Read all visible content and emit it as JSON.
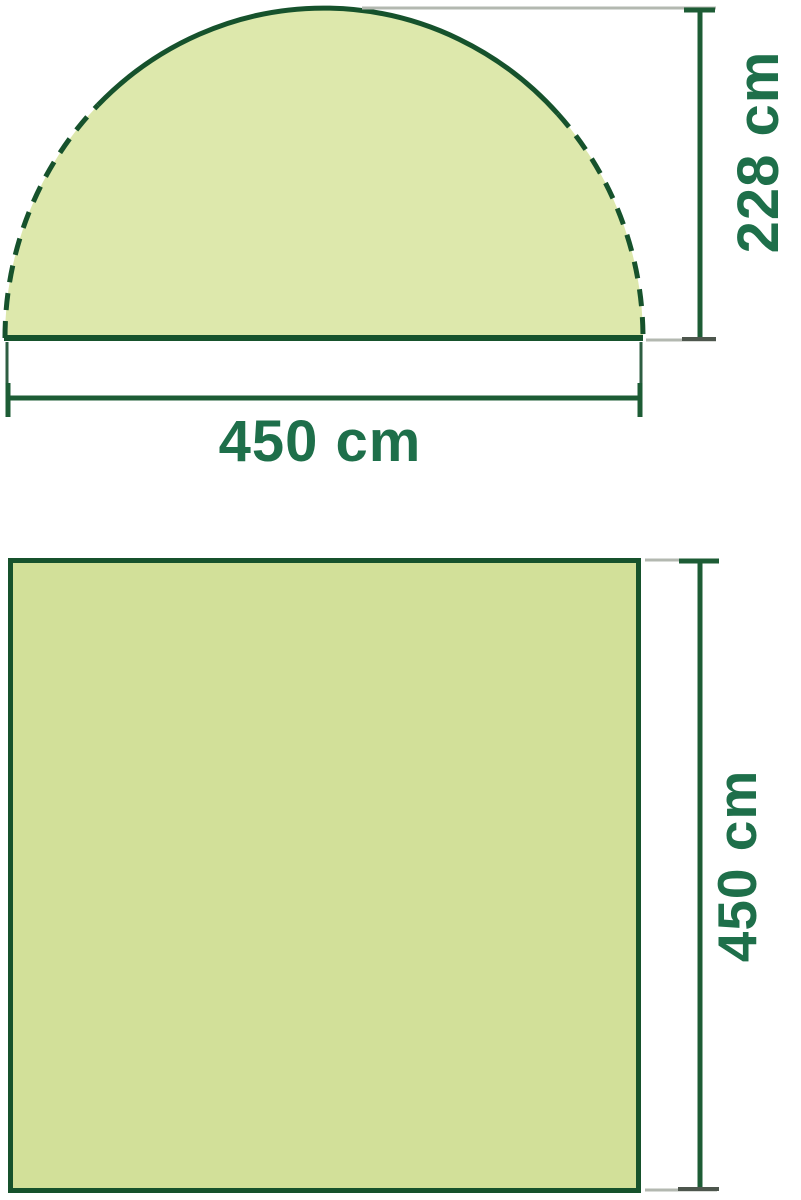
{
  "diagram": {
    "type": "product-dimension-diagram",
    "subject": "dome-shelter",
    "side_view": {
      "shape": "semi-dome",
      "height_label": "228 cm",
      "height_cm": 228,
      "width_label": "450 cm",
      "width_cm": 450
    },
    "floor_view": {
      "shape": "square",
      "depth_label": "450 cm",
      "depth_cm": 450
    },
    "colors": {
      "outline_green": "#16522c",
      "dimension_green": "#1d5c35",
      "label_green": "#1e6f4a",
      "dome_fill": "#dde8ac",
      "floor_fill": "#d2e099",
      "extension_gray": "#b3b8b0",
      "cap_gray": "#4d564d",
      "background": "#ffffff"
    }
  }
}
